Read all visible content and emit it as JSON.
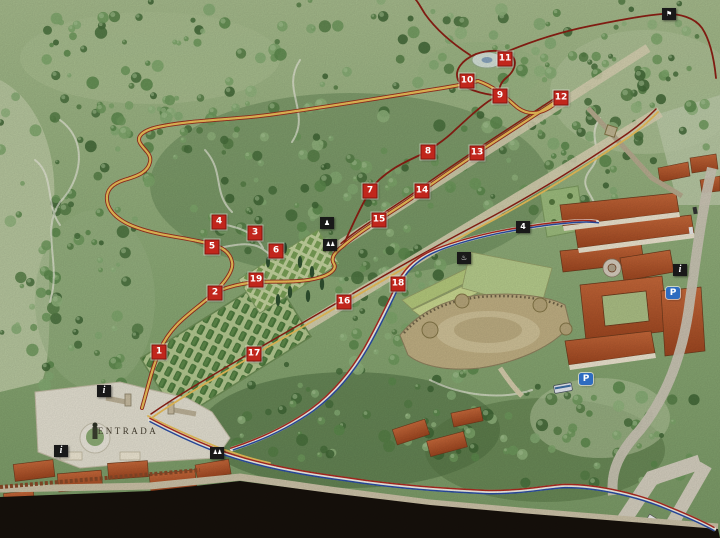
{
  "map": {
    "name": "illustrated-park-and-monastery-map",
    "entrance_label": "ENTRADA",
    "colors": {
      "marker_red": "#c1261c",
      "path_yellow": "#eec25a",
      "path_dark_red": "#8e1f14",
      "path_blue": "#2b4ea6",
      "path_stripe_red": "#b02a20",
      "parking_blue": "#2e6cc0",
      "icon_black": "#191919",
      "forest_green": "#7f9e6b"
    },
    "markers": [
      {
        "number": "1",
        "x": 159,
        "y": 352
      },
      {
        "number": "2",
        "x": 215,
        "y": 293
      },
      {
        "number": "3",
        "x": 255,
        "y": 233
      },
      {
        "number": "4",
        "x": 219,
        "y": 222
      },
      {
        "number": "5",
        "x": 212,
        "y": 247
      },
      {
        "number": "6",
        "x": 276,
        "y": 251
      },
      {
        "number": "7",
        "x": 370,
        "y": 191
      },
      {
        "number": "8",
        "x": 428,
        "y": 152
      },
      {
        "number": "9",
        "x": 500,
        "y": 96
      },
      {
        "number": "10",
        "x": 467,
        "y": 81
      },
      {
        "number": "11",
        "x": 505,
        "y": 59
      },
      {
        "number": "12",
        "x": 561,
        "y": 98
      },
      {
        "number": "13",
        "x": 477,
        "y": 153
      },
      {
        "number": "14",
        "x": 422,
        "y": 191
      },
      {
        "number": "15",
        "x": 379,
        "y": 220
      },
      {
        "number": "16",
        "x": 344,
        "y": 302
      },
      {
        "number": "17",
        "x": 254,
        "y": 354
      },
      {
        "number": "18",
        "x": 398,
        "y": 284
      },
      {
        "number": "19",
        "x": 256,
        "y": 280
      }
    ],
    "icons": [
      {
        "name": "viewpoint-icon",
        "type": "poi",
        "glyph": "⚑",
        "x": 669,
        "y": 14
      },
      {
        "name": "statue-icon",
        "type": "poi",
        "glyph": "♟",
        "x": 327,
        "y": 223
      },
      {
        "name": "wc-icon",
        "type": "wc",
        "glyph": "♟♟",
        "x": 330,
        "y": 245
      },
      {
        "name": "fountain-icon",
        "type": "poi",
        "glyph": "♨",
        "x": 464,
        "y": 258
      },
      {
        "name": "black-marker-4",
        "type": "num",
        "glyph": "4",
        "x": 523,
        "y": 227
      },
      {
        "name": "info-icon",
        "type": "info",
        "glyph": "i",
        "x": 104,
        "y": 391
      },
      {
        "name": "info-icon",
        "type": "info",
        "glyph": "i",
        "x": 61,
        "y": 451
      },
      {
        "name": "wc-icon",
        "type": "wc",
        "glyph": "♟♟",
        "x": 217,
        "y": 453
      },
      {
        "name": "info-icon",
        "type": "info",
        "glyph": "i",
        "x": 680,
        "y": 270
      },
      {
        "name": "parking-icon",
        "type": "parking",
        "glyph": "P",
        "x": 673,
        "y": 293
      },
      {
        "name": "parking-icon",
        "type": "parking",
        "glyph": "P",
        "x": 586,
        "y": 379
      }
    ],
    "entrance_label_pos": {
      "x": 128,
      "y": 431
    }
  }
}
